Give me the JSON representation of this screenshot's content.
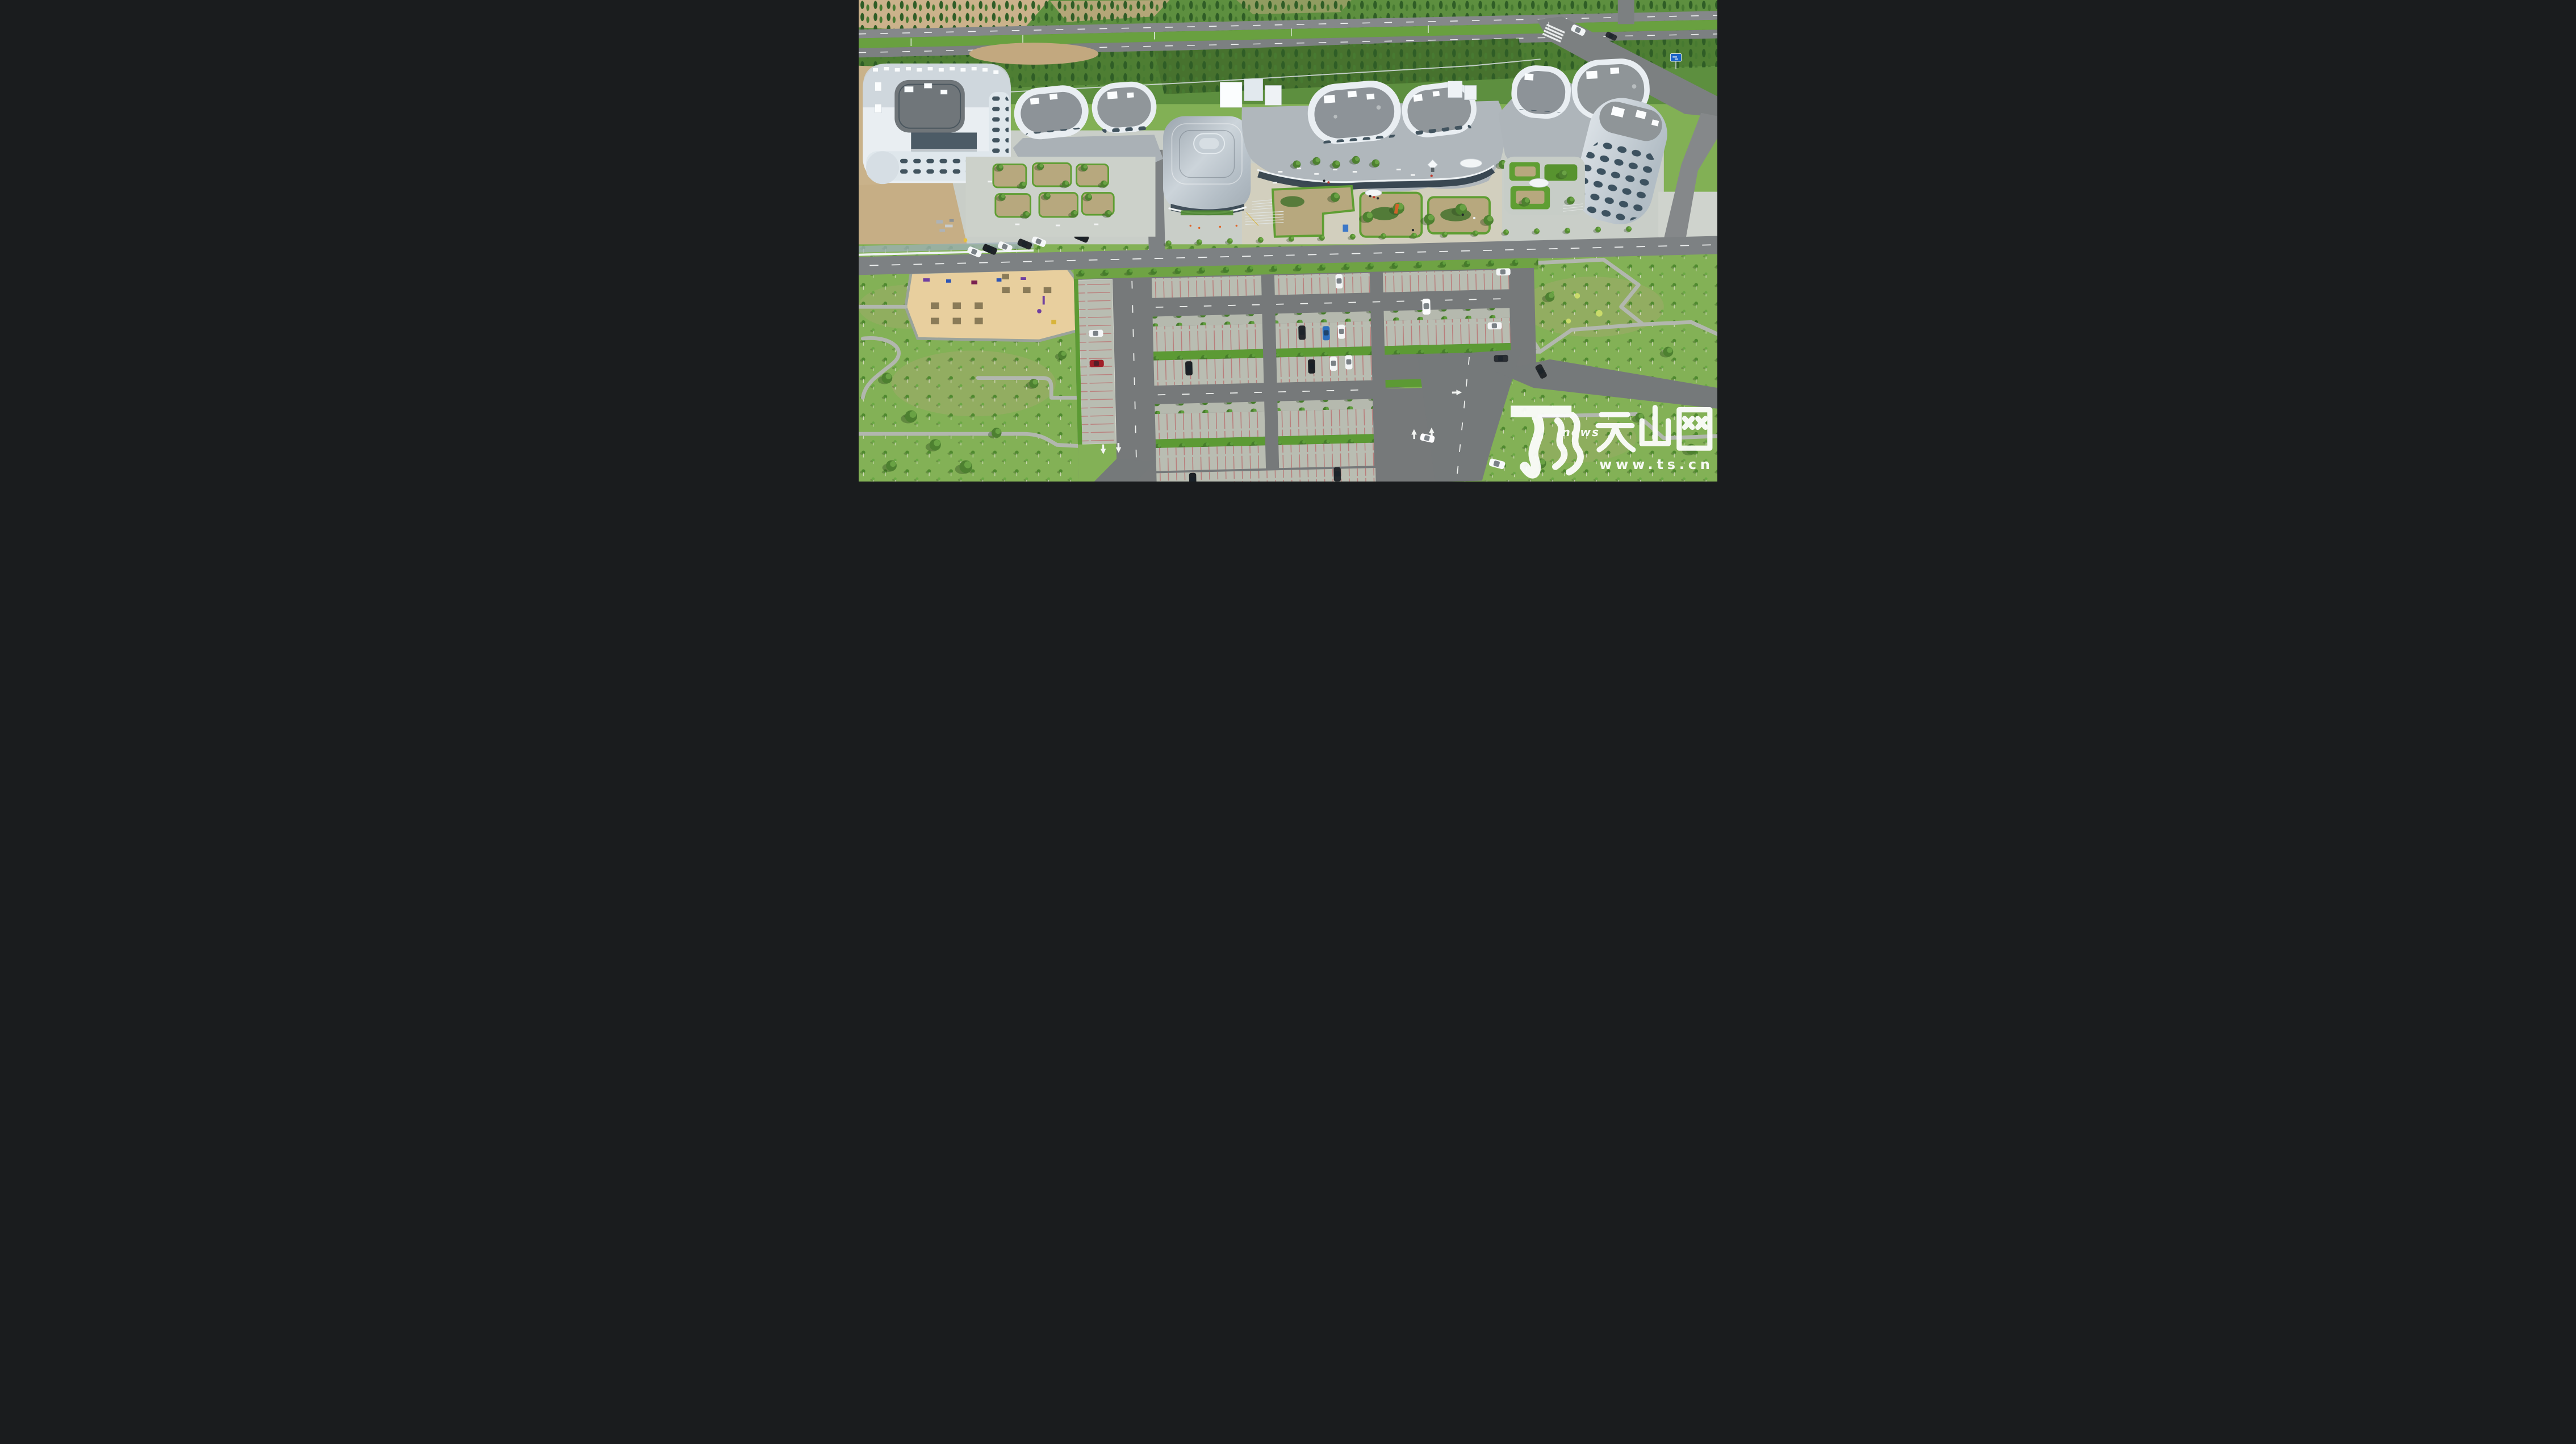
{
  "watermark": {
    "news_label": "news",
    "site_name": "天山网",
    "site_url": "www.ts.cn",
    "color": "#ffffff"
  },
  "palette": {
    "grass": "#82b055",
    "grass_dark": "#4f7e2e",
    "tree_dark": "#3f6b2a",
    "hedge": "#5c9a34",
    "building_white": "#e9eef2",
    "roof_gray": "#8f9598",
    "metal_silver": "#b7c2cb",
    "glass": "#2c3b46",
    "asphalt": "#7b7e80",
    "paver": "#b9bdb2",
    "stall_line": "#ba6a6a",
    "sand": "#cbb28b",
    "playground_sand": "#e8cf9e",
    "sign_blue": "#1b63c8",
    "car_red": "#a01f28",
    "accent_orange": "#d2622a"
  }
}
